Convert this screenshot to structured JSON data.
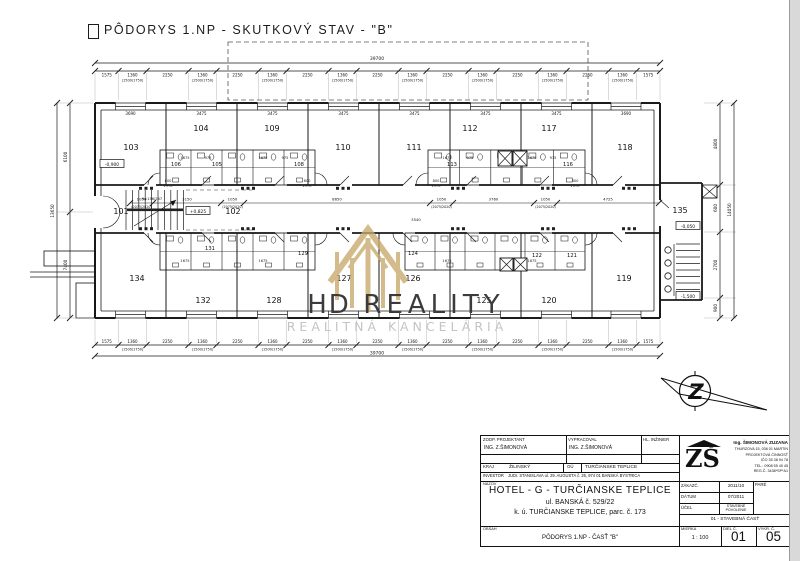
{
  "page": {
    "title": "PÔDORYS 1.NP - SKUTKOVÝ STAV - \"B\""
  },
  "plan": {
    "room_labels": [
      {
        "t": "103",
        "x": 131,
        "y": 150
      },
      {
        "t": "104",
        "x": 201,
        "y": 131
      },
      {
        "t": "109",
        "x": 272,
        "y": 131
      },
      {
        "t": "110",
        "x": 343,
        "y": 150
      },
      {
        "t": "111",
        "x": 414,
        "y": 150
      },
      {
        "t": "112",
        "x": 470,
        "y": 131
      },
      {
        "t": "117",
        "x": 549,
        "y": 131
      },
      {
        "t": "118",
        "x": 625,
        "y": 150
      },
      {
        "t": "101",
        "x": 121,
        "y": 214
      },
      {
        "t": "102",
        "x": 233,
        "y": 214
      },
      {
        "t": "135",
        "x": 680,
        "y": 213
      },
      {
        "t": "134",
        "x": 137,
        "y": 281
      },
      {
        "t": "132",
        "x": 203,
        "y": 303
      },
      {
        "t": "128",
        "x": 274,
        "y": 303
      },
      {
        "t": "127",
        "x": 344,
        "y": 281
      },
      {
        "t": "126",
        "x": 413,
        "y": 281
      },
      {
        "t": "125",
        "x": 484,
        "y": 303
      },
      {
        "t": "120",
        "x": 549,
        "y": 303
      },
      {
        "t": "119",
        "x": 624,
        "y": 281
      }
    ],
    "core_labels": [
      {
        "t": "106",
        "x": 176,
        "y": 166
      },
      {
        "t": "105",
        "x": 217,
        "y": 166
      },
      {
        "t": "108",
        "x": 299,
        "y": 166
      },
      {
        "t": "113",
        "x": 452,
        "y": 166
      },
      {
        "t": "116",
        "x": 568,
        "y": 166
      },
      {
        "t": "131",
        "x": 210,
        "y": 250
      },
      {
        "t": "129",
        "x": 303,
        "y": 255
      },
      {
        "t": "124",
        "x": 413,
        "y": 255
      },
      {
        "t": "122",
        "x": 537,
        "y": 257
      },
      {
        "t": "121",
        "x": 572,
        "y": 257
      }
    ],
    "width_labels": {
      "corner": "3690",
      "inner": "3475"
    },
    "levels": [
      {
        "t": "-0,900",
        "x": 112,
        "y": 166
      },
      {
        "t": "+0,825",
        "x": 198,
        "y": 213
      },
      {
        "t": "-0,050",
        "x": 688,
        "y": 228
      },
      {
        "t": "-1,500",
        "x": 688,
        "y": 298
      }
    ],
    "stair_note": "9×156/287",
    "micro_dims": [
      {
        "t": "1675",
        "x": 185,
        "y": 159
      },
      {
        "t": "975",
        "x": 208,
        "y": 159
      },
      {
        "t": "1675",
        "x": 263,
        "y": 159
      },
      {
        "t": "975",
        "x": 285,
        "y": 159
      },
      {
        "t": "800",
        "x": 168,
        "y": 182
      },
      {
        "t": "1970",
        "x": 168,
        "y": 187
      },
      {
        "t": "800",
        "x": 307,
        "y": 182
      },
      {
        "t": "1970",
        "x": 307,
        "y": 187
      },
      {
        "t": "1675",
        "x": 447,
        "y": 159
      },
      {
        "t": "975",
        "x": 470,
        "y": 159
      },
      {
        "t": "1675",
        "x": 532,
        "y": 159
      },
      {
        "t": "975",
        "x": 553,
        "y": 159
      },
      {
        "t": "800",
        "x": 436,
        "y": 182
      },
      {
        "t": "1970",
        "x": 436,
        "y": 187
      },
      {
        "t": "800",
        "x": 575,
        "y": 182
      },
      {
        "t": "1970",
        "x": 575,
        "y": 187
      },
      {
        "t": "1675",
        "x": 185,
        "y": 262
      },
      {
        "t": "1675",
        "x": 263,
        "y": 262
      },
      {
        "t": "1675",
        "x": 447,
        "y": 262
      },
      {
        "t": "1675",
        "x": 532,
        "y": 262
      }
    ],
    "dims": {
      "overall": "39700",
      "edge": "1575",
      "window": "1360",
      "window_sub": "(1500/1750)",
      "pier": "2250",
      "left_segments": [
        "6100",
        "7400"
      ],
      "left_overall": "13650",
      "right_segments": [
        "4800",
        "600",
        "2700",
        "900"
      ],
      "right_overall": "14050",
      "corridor_segments": [
        {
          "t": "1050",
          "sub": "(2075/2020)"
        },
        {
          "t": "3150"
        },
        {
          "t": "1050",
          "sub": "(2075/2020)"
        },
        {
          "t": "8650"
        },
        {
          "t": "1050",
          "sub": "(2075/2020)"
        },
        {
          "t": "3760"
        },
        {
          "t": "1050",
          "sub": "(2075/2020)"
        },
        {
          "t": "4725"
        }
      ],
      "corridor_extra": "3540"
    }
  },
  "watermark": {
    "hd": "HD",
    "reality": "REALITY",
    "subtitle": "REALITNÁ KANCELÁRIA",
    "color": "#c9a86b"
  },
  "north": {
    "letter": "Z"
  },
  "titleblock": {
    "zodp_label": "ZODP. PROJEKTANT",
    "zodp": "ING. Z.ŠIMONOVÁ",
    "vypracoval_label": "VYPRACOVAL",
    "vypracoval": "ING. Z.ŠIMONOVÁ",
    "hl_label": "HL. INŽINIER",
    "hl": "",
    "kraj_label": "KRAJ",
    "kraj": "ŽILINSKÝ",
    "ou_label": "OÚ",
    "ou": "TURČIANSKE TEPLICE",
    "investor_label": "INVESTOR",
    "investor": "JUDr. STANISLAVA ul. 29. AUGUSTA č. 25, 974 01 BANSKÁ BYSTRICA",
    "nazov_label": "NÁZOV",
    "nazov1": "HOTEL  -  G  -  TURČIANSKE  TEPLICE",
    "nazov2": "ul. BANSKÁ č. 529/22",
    "nazov3": "k. ú.  TURČIANSKE TEPLICE, parc. č. 173",
    "zakazc_label": "ZÁKAZČ.",
    "zakazc": "2011/10",
    "datum_label": "DÁTUM",
    "datum": "07/2011",
    "ucel_label": "ÚČEL",
    "ucel1": "STAVEBNÉ",
    "ucel2": "POVOLENIE",
    "cast": "01 - STAVEBNÁ ČASŤ",
    "pare_label": "PARÉ",
    "obsah_label": "OBSAH",
    "obsah": "PÔDORYS 1.NP - ČASŤ \"B\"",
    "mierka_label": "MIERKA",
    "mierka": "1 : 100",
    "diel_label": "DIEL Č.",
    "diel": "01",
    "vykr_label": "VÝKR. Č.",
    "vykr": "05",
    "stamp": {
      "zs": "ZŠ",
      "name": "Ing. ŠIMONOVÁ ZUZANA",
      "l1": "THURZOVA 15, 036 01 MARTIN",
      "l2": "PROJEKTOVÁ ČINNOSŤ",
      "l3": "IČO 35 38 94 78",
      "l4": "TEL.: 0908 55 40 45",
      "l5": "REG.Č. 3438*SP*A1"
    }
  }
}
